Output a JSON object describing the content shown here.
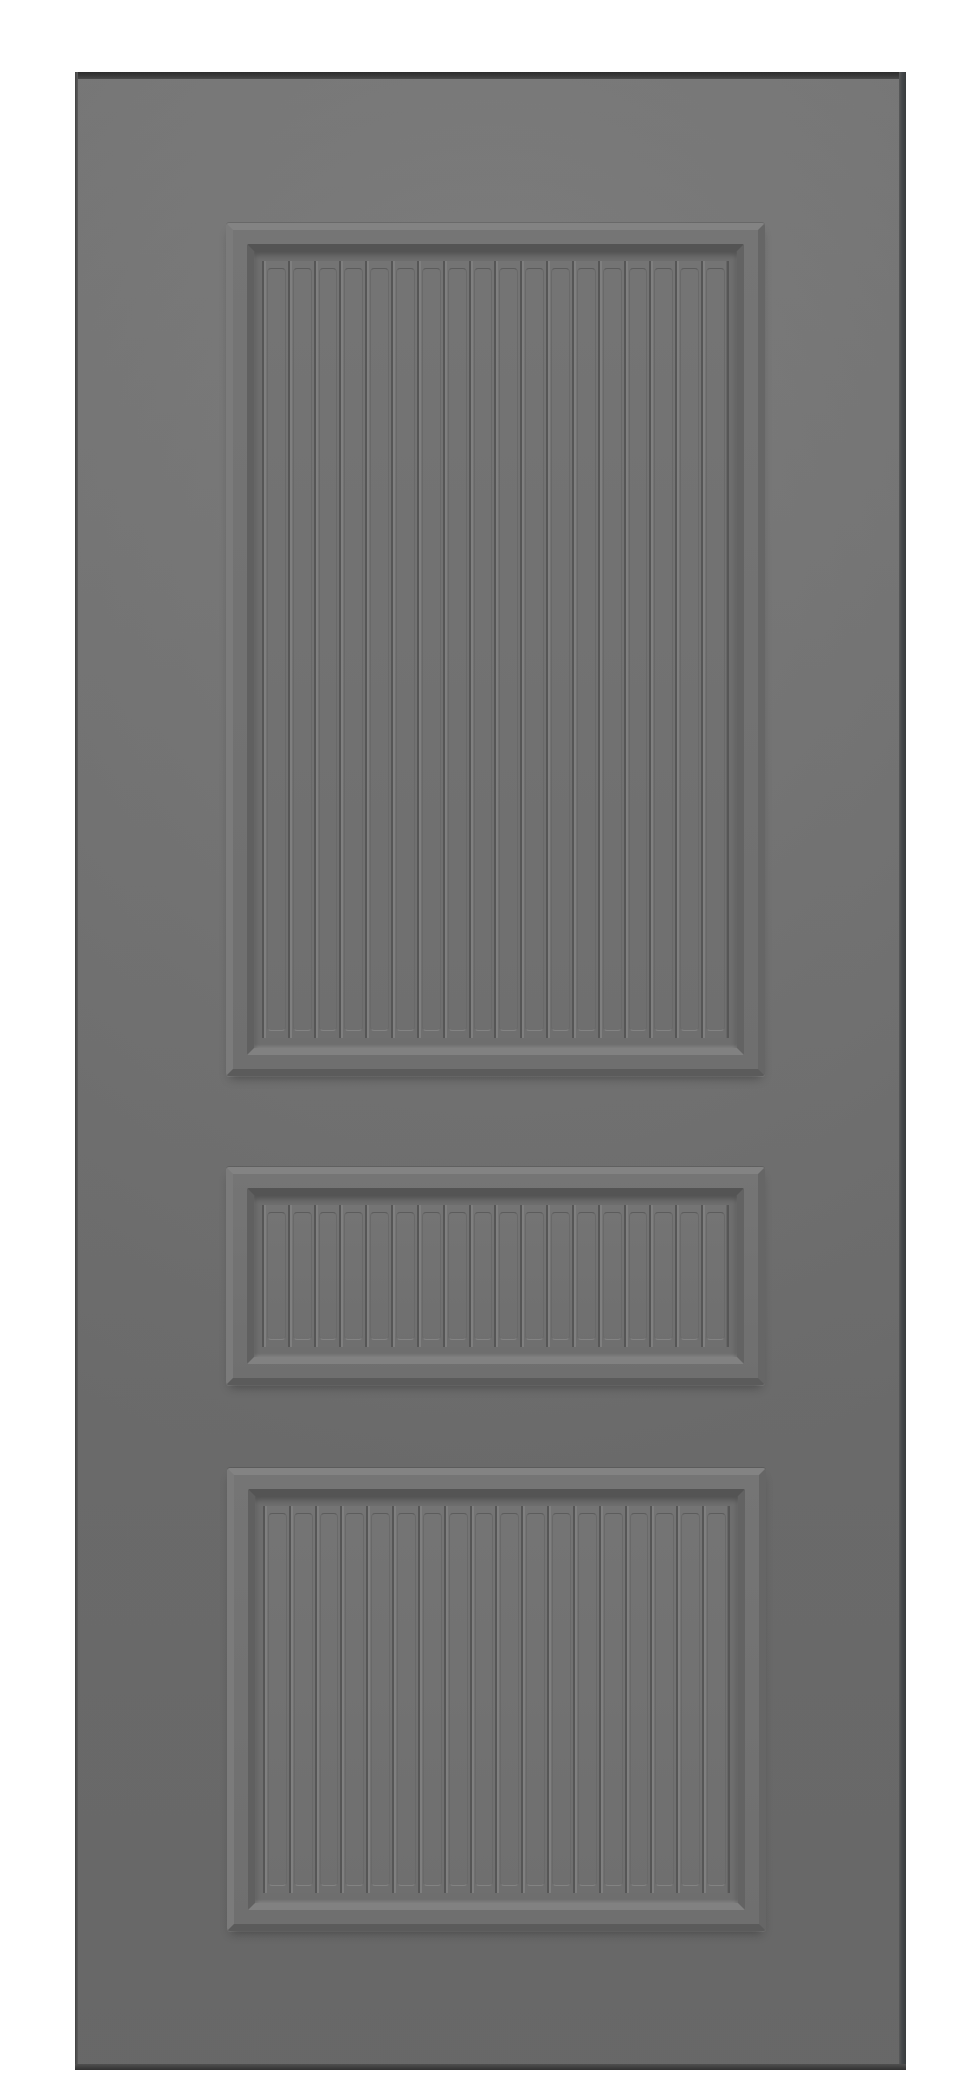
{
  "image": {
    "type": "product-photo",
    "subject": "Gray three-panel interior door slab, front view, centered on a white background",
    "background_color": "#ffffff"
  },
  "door": {
    "face_color": "#717171",
    "face_gradient_top": "#777777",
    "face_gradient_bottom": "#6d6d6d",
    "top_edge_color": "#2d2d2d",
    "left_edge_color": "#424242",
    "right_edge_color": "#393c3d",
    "bottom_edge_color": "#323232",
    "molding_highlight_color": "#838383",
    "molding_shadow_color": "#5b5b5b",
    "recess_shadow_color": "#545454",
    "groove_color": "#565656",
    "groove_highlight_color": "#7f7f7f",
    "panels": [
      {
        "id": "top-panel",
        "style": "raised frame, recessed beadboard field",
        "battens": 18
      },
      {
        "id": "middle-panel",
        "style": "raised frame, recessed beadboard field",
        "battens": 18
      },
      {
        "id": "bottom-panel",
        "style": "raised frame, recessed beadboard field",
        "battens": 18
      }
    ]
  }
}
